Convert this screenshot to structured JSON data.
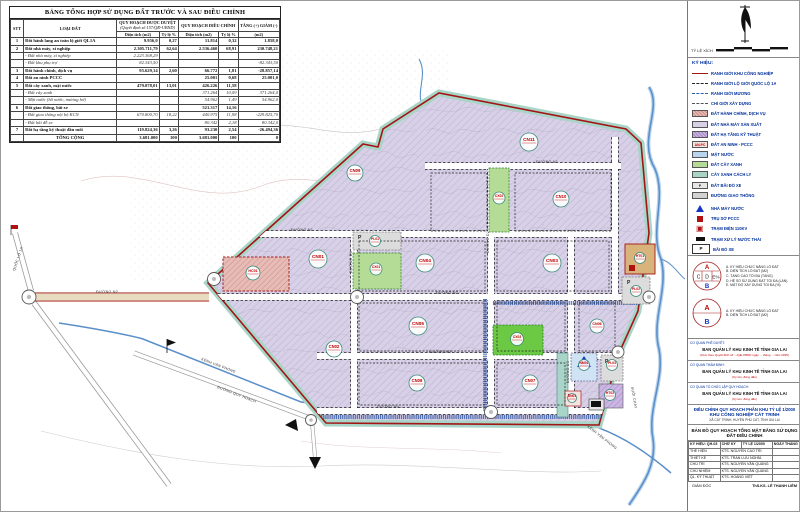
{
  "colors": {
    "boundary_red": "#a31515",
    "factory_lavender": "#d7d0e6",
    "green": "#b5dc96",
    "bright_green": "#6cc944",
    "isolation_teal": "#a8d5c8",
    "admin_pink": "#e7bcb6",
    "infra_tan": "#d9b37c",
    "water_blue": "#5b8fc9",
    "road_gray": "#d2d2d2",
    "label_red": "#c00000"
  },
  "table": {
    "title": "BẢNG TỔNG HỢP SỬ DỤNG ĐẤT TRƯỚC VÀ SAU ĐIỀU CHỈNH",
    "col_stt": "STT",
    "col_type": "LOẠI ĐẤT",
    "grp_approved": "QUY HOẠCH ĐƯỢC DUYỆT",
    "grp_approved_note": "(Quyết định số 157/QĐ-UBND)",
    "grp_adjusted": "QUY HOẠCH ĐIỀU CHỈNH",
    "grp_delta": "TĂNG (+) GIẢM (-)",
    "sub_area": "Diện tích (m2)",
    "sub_ratio": "Tỷ lệ %",
    "sub_delta": "(m2)",
    "rows": [
      {
        "stt": "1",
        "name": "Đất hành lang an toàn lộ giới QL1A",
        "a_dt": "9.956,0",
        "a_tl": "0,27",
        "d_dt": "11.814",
        "d_tl": "0,32",
        "delta": "1.858,0",
        "sub": false
      },
      {
        "stt": "2",
        "name": "Đất nhà máy, xí nghiệp",
        "a_dt": "2.305.711,79",
        "a_tl": "62,64",
        "d_dt": "2.536.460",
        "d_tl": "68,91",
        "delta": "230.748,21",
        "sub": false
      },
      {
        "stt": "",
        "name": "- Đất nhà máy, xí nghiệp",
        "a_dt": "2.223.368,29",
        "a_tl": "",
        "d_dt": "",
        "d_tl": "",
        "delta": "",
        "sub": true
      },
      {
        "stt": "",
        "name": "- Đất khu phụ trợ",
        "a_dt": "82.343,50",
        "a_tl": "",
        "d_dt": "",
        "d_tl": "",
        "delta": "-82.343,50",
        "sub": true
      },
      {
        "stt": "3",
        "name": "Đất hành chính, dịch vụ",
        "a_dt": "95.629,14",
        "a_tl": "2,60",
        "d_dt": "66.772",
        "d_tl": "1,81",
        "delta": "-28.857,14",
        "sub": false
      },
      {
        "stt": "4",
        "name": "Đất an ninh PCCC",
        "a_dt": "",
        "a_tl": "",
        "d_dt": "25.001",
        "d_tl": "0,68",
        "delta": "25.001,0",
        "sub": false
      },
      {
        "stt": "5",
        "name": "Đất cây xanh, mặt nước",
        "a_dt": "479.078,01",
        "a_tl": "13,01",
        "d_dt": "426.226",
        "d_tl": "11,58",
        "delta": "",
        "sub": false
      },
      {
        "stt": "",
        "name": "- Đất cây xanh",
        "a_dt": "",
        "a_tl": "",
        "d_dt": "371.264",
        "d_tl": "10,09",
        "delta": "371.264,0",
        "sub": true
      },
      {
        "stt": "",
        "name": "- Mặt nước (hồ nước, mương hở)",
        "a_dt": "",
        "a_tl": "",
        "d_dt": "54.962",
        "d_tl": "1,49",
        "delta": "54.962,0",
        "sub": true
      },
      {
        "stt": "6",
        "name": "Đất giao thông, bãi xe",
        "a_dt": "",
        "a_tl": "",
        "d_dt": "521.317",
        "d_tl": "14,16",
        "delta": "",
        "sub": false
      },
      {
        "stt": "",
        "name": "- Đất giao thông nội bộ KCN",
        "a_dt": "670.800,70",
        "a_tl": "18,22",
        "d_dt": "440.975",
        "d_tl": "11,98",
        "delta": "-229.825,70",
        "sub": true
      },
      {
        "stt": "",
        "name": "- Đất bãi đỗ xe",
        "a_dt": "",
        "a_tl": "",
        "d_dt": "80.342",
        "d_tl": "2,18",
        "delta": "80.342,0",
        "sub": true
      },
      {
        "stt": "7",
        "name": "Đất hạ tầng kỹ thuật đầu mối",
        "a_dt": "119.824,36",
        "a_tl": "3,26",
        "d_dt": "93.230",
        "d_tl": "2,54",
        "delta": "-26.494,36",
        "sub": false
      }
    ],
    "total": {
      "name": "TỔNG CỘNG",
      "a_dt": "3.681.000",
      "a_tl": "100",
      "d_dt": "3.681.000",
      "d_tl": "100",
      "delta": "0"
    }
  },
  "map": {
    "parcels": [
      {
        "label": "CN01",
        "x": 317,
        "y": 258,
        "r": 9
      },
      {
        "label": "CN02",
        "x": 333,
        "y": 348,
        "r": 8
      },
      {
        "label": "CN03",
        "x": 551,
        "y": 262,
        "r": 9
      },
      {
        "label": "CN04",
        "x": 424,
        "y": 262,
        "r": 9
      },
      {
        "label": "CN05",
        "x": 417,
        "y": 325,
        "r": 9
      },
      {
        "label": "CN06",
        "x": 596,
        "y": 325,
        "r": 7
      },
      {
        "label": "CN07",
        "x": 529,
        "y": 382,
        "r": 8
      },
      {
        "label": "CN08",
        "x": 416,
        "y": 382,
        "r": 8
      },
      {
        "label": "CN09",
        "x": 354,
        "y": 172,
        "r": 8
      },
      {
        "label": "CN10",
        "x": 560,
        "y": 198,
        "r": 8
      },
      {
        "label": "CN11",
        "x": 528,
        "y": 141,
        "r": 9
      },
      {
        "label": "CX01",
        "x": 375,
        "y": 268,
        "r": 6
      },
      {
        "label": "CX02",
        "x": 498,
        "y": 197,
        "r": 6
      },
      {
        "label": "CX03",
        "x": 516,
        "y": 338,
        "r": 6.5
      },
      {
        "label": "HC01",
        "x": 252,
        "y": 272,
        "r": 7
      },
      {
        "label": "PL01",
        "x": 374,
        "y": 240,
        "r": 5.5
      },
      {
        "label": "HT01",
        "x": 639,
        "y": 257,
        "r": 5.5
      },
      {
        "label": "PL02",
        "x": 635,
        "y": 290,
        "r": 5.5
      },
      {
        "label": "PL03",
        "x": 611,
        "y": 364,
        "r": 5.5
      },
      {
        "label": "HT02",
        "x": 609,
        "y": 394,
        "r": 5.5
      },
      {
        "label": "NM01",
        "x": 583,
        "y": 364,
        "r": 5.5
      },
      {
        "label": "AN01",
        "x": 571,
        "y": 397,
        "r": 4.5
      }
    ],
    "road_labels": [
      {
        "text": "QUỐC LỘ 1A",
        "x": 14,
        "y": 270,
        "rot": -72
      },
      {
        "text": "ĐƯỜNG N2",
        "x": 95,
        "y": 292,
        "rot": 0
      },
      {
        "text": "ĐƯỜNG N1",
        "x": 290,
        "y": 230,
        "rot": 0
      },
      {
        "text": "ĐƯỜNG N1",
        "x": 535,
        "y": 162,
        "rot": 0
      },
      {
        "text": "ĐƯỜNG N2",
        "x": 435,
        "y": 293,
        "rot": 0
      },
      {
        "text": "ĐƯỜNG N3",
        "x": 428,
        "y": 352,
        "rot": 0
      },
      {
        "text": "ĐƯỜNG N4",
        "x": 376,
        "y": 407,
        "rot": 0
      },
      {
        "text": "ĐƯỜNG D1",
        "x": 351,
        "y": 272,
        "rot": -90
      },
      {
        "text": "ĐƯỜNG D2",
        "x": 488,
        "y": 252,
        "rot": -90
      },
      {
        "text": "ĐƯỜNG D3",
        "x": 568,
        "y": 382,
        "rot": -90
      },
      {
        "text": "KÊNH VĂN PHONG",
        "x": 200,
        "y": 359,
        "rot": 21
      },
      {
        "text": "ĐƯỜNG QUY HOẠCH",
        "x": 216,
        "y": 387,
        "rot": 21
      },
      {
        "text": "KÊNH VĂN PHONG",
        "x": 586,
        "y": 426,
        "rot": 38
      },
      {
        "text": "SUỐI CHAY",
        "x": 630,
        "y": 386,
        "rot": 80
      }
    ]
  },
  "panel": {
    "scale_label": "TỶ LỆ XÍCH",
    "legend_title": "KÝ HIỆU:",
    "legend": [
      {
        "swatch": "ln ln-red",
        "label": "RANH GIỚI KHU CÔNG NGHIỆP"
      },
      {
        "swatch": "ln ln-dashdot",
        "label": "RANH GIỚI LỘ GIỚI QUỐC LỘ 1A"
      },
      {
        "swatch": "ln ln-blue",
        "label": "RANH GIỚI MƯƠNG"
      },
      {
        "swatch": "ln ln-dash",
        "label": "CHỈ GIỚI XÂY DỰNG"
      },
      {
        "swatch": "sw sw-hc",
        "label": "ĐẤT HÀNH CHÍNH, DỊCH VỤ"
      },
      {
        "swatch": "sw sw-cn",
        "label": "ĐẤT NHÀ MÁY SẢN XUẤT"
      },
      {
        "swatch": "sw sw-ht",
        "label": "ĐẤT HẠ TẦNG KỸ THUẬT"
      },
      {
        "swatch": "sw sw-an",
        "glyph": "AN-PC",
        "label": "ĐẤT AN NINH - PCCC"
      },
      {
        "swatch": "sw sw-mn",
        "label": "MẶT NƯỚC"
      },
      {
        "swatch": "sw sw-cx",
        "label": "ĐẤT CÂY XANH"
      },
      {
        "swatch": "sw sw-cl",
        "label": "CÂY XANH CÁCH LY"
      },
      {
        "swatch": "sw sw-p",
        "glyph": "P",
        "label": "ĐẤT BÃI ĐỖ XE"
      },
      {
        "swatch": "sw sw-gt",
        "label": "ĐƯỜNG GIAO THÔNG"
      }
    ],
    "symbols": [
      {
        "swatch": "sy sy-tri",
        "label": "NHÀ MÁY NƯỚC"
      },
      {
        "swatch": "sy sy-sq-red",
        "label": "TRỤ SỞ PCCC"
      },
      {
        "swatch": "sy sy-sq-x",
        "label": "TRẠM ĐIỆN 110KV"
      },
      {
        "swatch": "sy sy-blk",
        "label": "TRẠM XỬ LÝ NƯỚC THẢI"
      },
      {
        "swatch": "sy sy-p",
        "glyph": "P",
        "label": "BÃI ĐỖ XE"
      }
    ],
    "circle1_notes": [
      "A. KÝ HIỆU CHỨC NĂNG LÔ ĐẤT",
      "B. DIỆN TÍCH LÔ ĐẤT (M2)",
      "C. TẦNG CAO TỐI ĐA (TẦNG)",
      "D. HỆ SỐ SỬ DỤNG ĐẤT TỐI ĐA (LẦN)",
      "E. MẬT ĐỘ XÂY DỰNG TỐI ĐA (%)"
    ],
    "circle2_notes": [
      "A. KÝ HIỆU CHỨC NĂNG LÔ ĐẤT",
      "B. DIỆN TÍCH LÔ ĐẤT (M2)"
    ],
    "circle_parts": {
      "a": "A",
      "b": "B",
      "c": "C",
      "d": "D",
      "e": "E%"
    },
    "title_block": {
      "orgs": [
        {
          "dept": "CƠ QUAN PHÊ DUYỆT:",
          "name": "BAN QUẢN LÝ KHU KINH TẾ TỈNH GIA LAI",
          "note": "(Kèm theo Quyết định số .../QĐ-UBND ngày ... tháng ... năm 2025)"
        },
        {
          "dept": "CƠ QUAN THẨM ĐỊNH:",
          "name": "BAN QUẢN LÝ KHU KINH TẾ TỈNH GIA LAI",
          "note": "(Ký tên, đóng dấu)"
        },
        {
          "dept": "CƠ QUAN TỔ CHỨC LẬP QUY HOẠCH:",
          "name": "BAN QUẢN LÝ KHU KINH TẾ TỈNH GIA LAI",
          "note": "(Ký tên, đóng dấu)"
        }
      ],
      "project_line1": "ĐIỀU CHỈNH QUY HOẠCH PHÂN KHU TỶ LỆ 1/2000",
      "project_line2": "KHU CÔNG NGHIỆP CÁT TRINH",
      "project_line3": "XÃ CÁT TRINH, HUYỆN PHÙ CÁT, TỈNH GIA LAI",
      "drawing_title": "BẢN ĐỒ QUY HOẠCH TỔNG MẶT BẰNG SỬ DỤNG ĐẤT ĐIỀU CHỈNH",
      "staff_header": [
        "KÝ HIỆU: QH-03",
        "CHỮ KÝ",
        "TỶ LỆ 1/2000",
        "NGÀY THÁNG"
      ],
      "staff_rows": [
        [
          "THỂ HIỆN",
          "KTS. NGUYỄN CAO TRÍ"
        ],
        [
          "THIẾT KẾ",
          "KTS. TRẦN LƯU NGHĨA"
        ],
        [
          "CHỦ TRÌ",
          "KTS. NGUYỄN VĂN QUẢNG"
        ],
        [
          "CHỦ NHIỆM",
          "KTS. NGUYỄN VĂN QUẢNG"
        ],
        [
          "QL. KỸ THUẬT",
          "KTS. HOÀNG VIỆT"
        ]
      ],
      "director_label": "GIÁM ĐỐC",
      "director_name": "ThS.KS. LÊ THANH LIÊM"
    }
  }
}
